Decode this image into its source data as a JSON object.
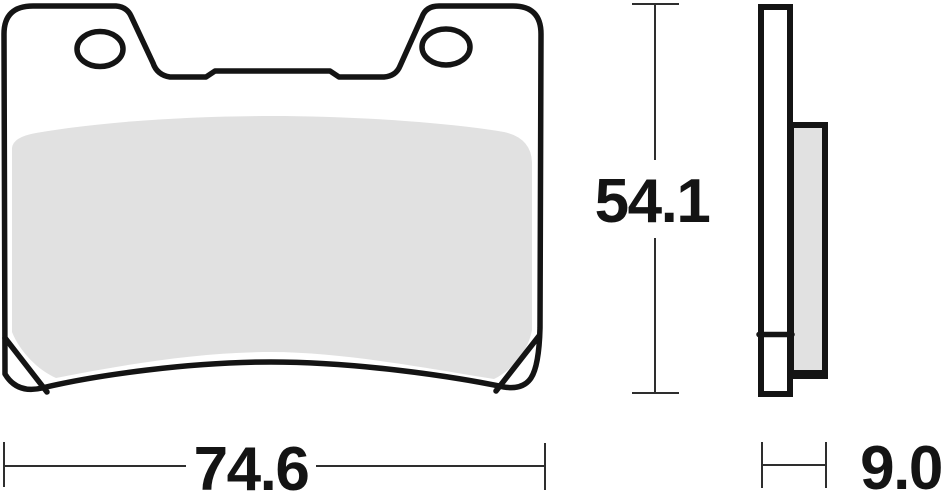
{
  "dimensions": {
    "width": "74.6",
    "height": "54.1",
    "thickness": "9.0"
  },
  "colors": {
    "outline": "#141414",
    "friction_material": "#e1e1e1",
    "dimension_line": "#2e2e2e",
    "text": "#141414",
    "background": "#ffffff"
  }
}
